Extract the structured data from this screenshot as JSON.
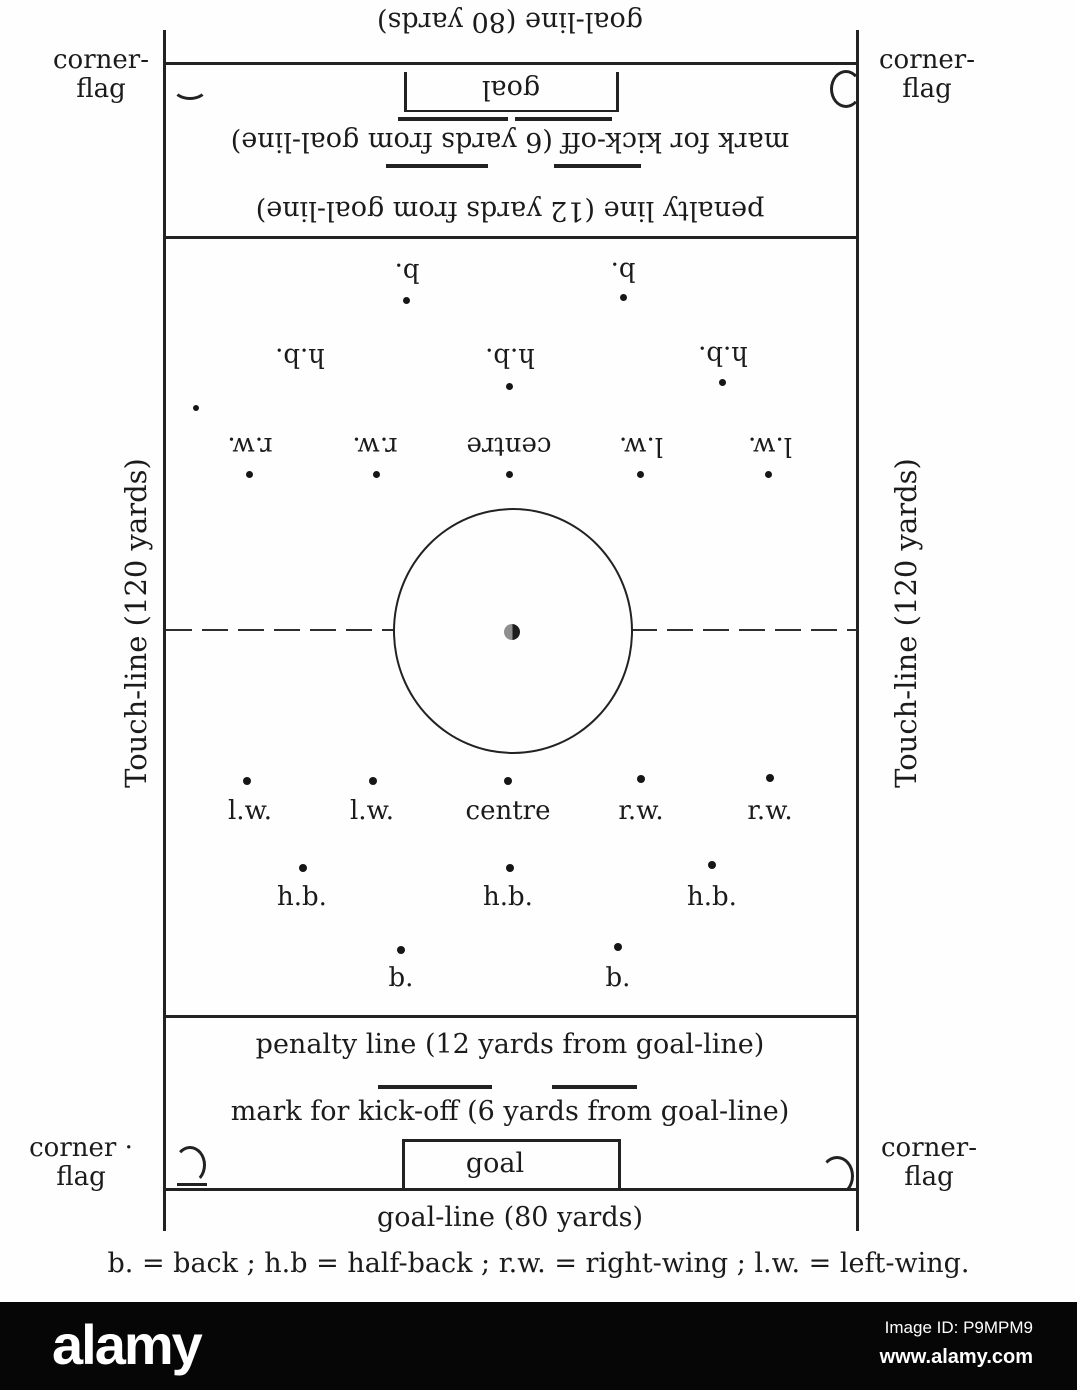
{
  "legend": "b. = back ;  h.b = half-back ;  r.w. = right-wing ;  l.w. = left-wing.",
  "field": {
    "touchline_left": "Touch-line (120 yards)",
    "touchline_right": "Touch-line (120 yards)",
    "corners": {
      "top_left": {
        "line1": "corner-",
        "line2": "flag"
      },
      "top_right": {
        "line1": "corner-",
        "line2": "flag"
      },
      "bottom_left": {
        "line1": "corner ·",
        "line2": "flag"
      },
      "bottom_right": {
        "line1": "corner-",
        "line2": "flag"
      }
    }
  },
  "top_half": {
    "goal_line_label": "goal-line (80 yards)",
    "goal_label": "goal",
    "kickoff_label": "mark for kick-off (6 yards from goal-line)",
    "penalty_label": "penalty line (12 yards from goal-line)",
    "positions": {
      "backs": [
        "b.",
        "b."
      ],
      "half_backs": [
        "h.b.",
        "h.b.",
        "h.b."
      ],
      "forwards": [
        "r.w.",
        "r.w.",
        "centre",
        "l.w.",
        "l.w."
      ]
    }
  },
  "bottom_half": {
    "goal_line_label": "goal-line (80 yards)",
    "goal_label": "goal",
    "kickoff_label": "mark for kick-off (6 yards from goal-line)",
    "penalty_label": "penalty line (12 yards from goal-line)",
    "positions": {
      "backs": [
        "b.",
        "b."
      ],
      "half_backs": [
        "h.b.",
        "h.b.",
        "h.b."
      ],
      "forwards": [
        "l.w.",
        "l.w.",
        "centre",
        "r.w.",
        "r.w."
      ]
    }
  },
  "watermark": {
    "brand": "alamy",
    "image_id": "Image ID: P9MPM9",
    "url": "www.alamy.com"
  }
}
